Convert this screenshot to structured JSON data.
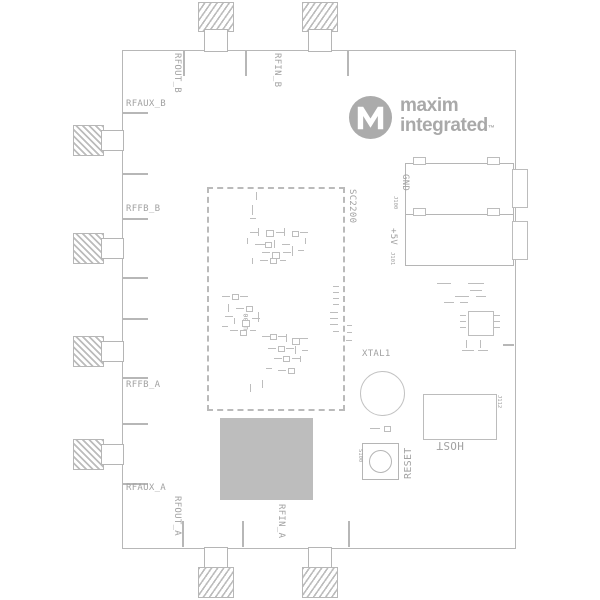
{
  "logo": {
    "m": "M",
    "line1": "maxim",
    "line2": "integrated",
    "tm": "™"
  },
  "labels": {
    "rfout_b": "RFOUT_B",
    "rfin_b": "RFIN_B",
    "rfaux_b": "RFAUX_B",
    "rffb_b": "RFFB_B",
    "rffb_a": "RFFB_A",
    "rfaux_a": "RFAUX_A",
    "rfout_a": "RFOUT_A",
    "rfin_a": "RFIN_A",
    "gnd": "GND",
    "p5v": "+5V",
    "j100": "J100",
    "j101": "J101",
    "sc2200": "SC2200",
    "u100": "U100",
    "xtal1": "XTAL1",
    "reset": "RESET",
    "s100": "S100",
    "host": "HOST",
    "j112": "J112"
  },
  "colors": {
    "line": "#b7b7b7",
    "silkscreen_text": "#a2a2a2",
    "logo_gray": "#a9a9a9",
    "shield_fill": "#bdbdbd",
    "background": "#ffffff"
  }
}
